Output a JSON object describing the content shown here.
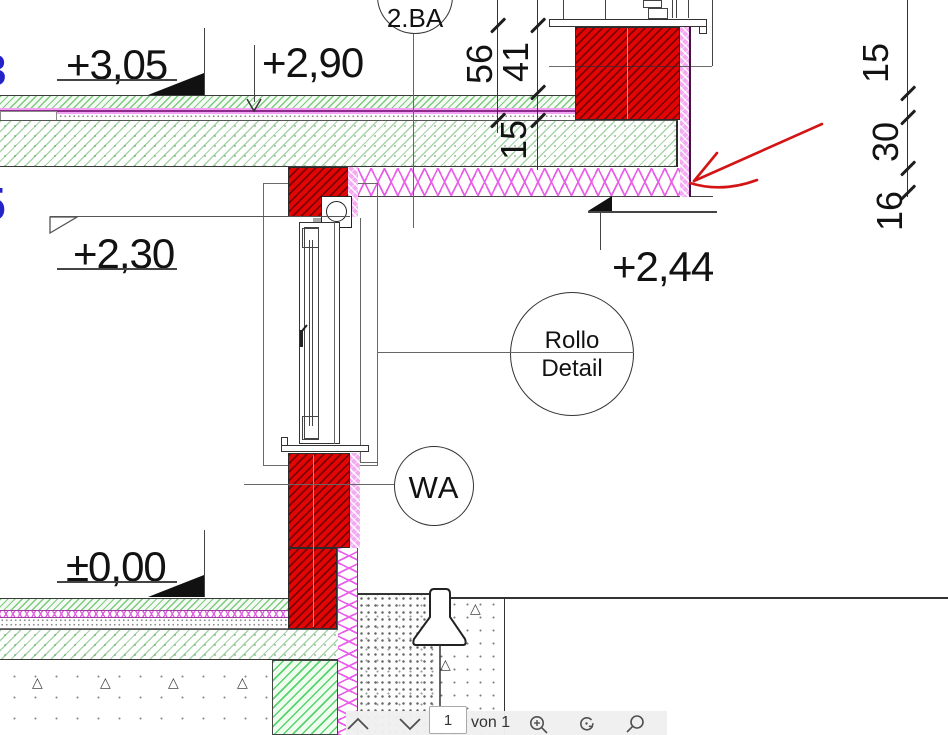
{
  "viewer_toolbar": {
    "page_input_value": "1",
    "page_count_label": "von 1"
  },
  "drawing": {
    "levels": {
      "top_finish": "+3,05",
      "top_raw": "+2,90",
      "lintel_raw": "+2,30",
      "cantilever_finish": "+2,44",
      "ground_finish": "±0,00"
    },
    "callouts": {
      "construction_stage": "2.BA",
      "rollo_line1": "Rollo",
      "rollo_line2": "Detail",
      "wall_marker": "WA"
    },
    "dim_chain_parapet": [
      "56",
      "41",
      "15"
    ],
    "dim_chain_right": [
      "15",
      "30",
      "16"
    ],
    "partial_glyphs": [
      "3",
      "5"
    ],
    "colors": {
      "masonry_red": "#e10505",
      "insulation_magenta": "#ea5fea",
      "concrete_hatch_green": "#57aa57",
      "annotation_arrow_red": "#d41414"
    }
  }
}
